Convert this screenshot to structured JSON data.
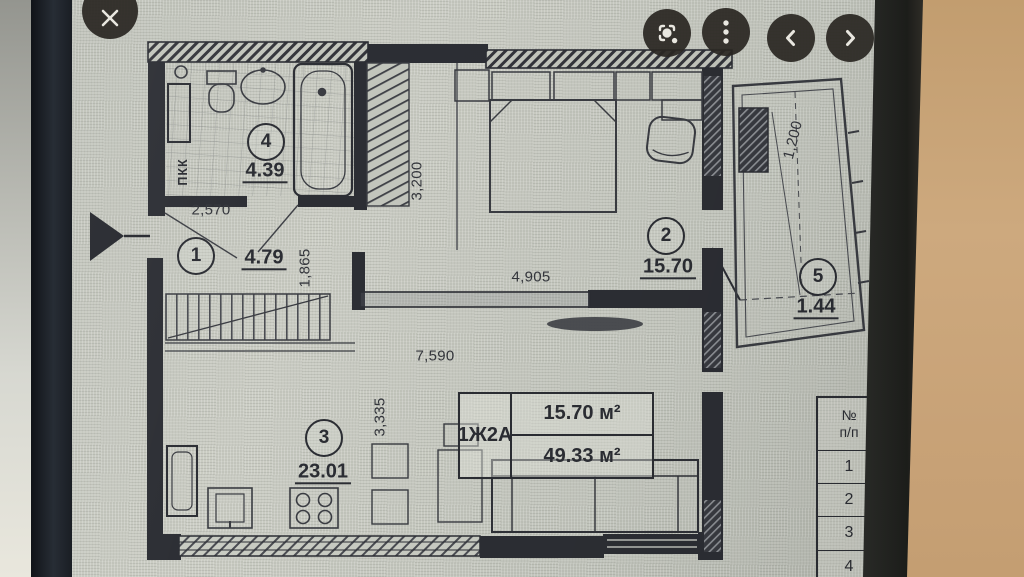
{
  "toolbar": {
    "icons": {
      "close": "close-icon",
      "lens": "lens-search-icon",
      "more": "more-options-icon",
      "previous": "previous-image-icon",
      "next": "next-image-icon"
    }
  },
  "plan": {
    "rooms": [
      {
        "number": "1",
        "area": "4.79"
      },
      {
        "number": "2",
        "area": "15.70"
      },
      {
        "number": "3",
        "area": "23.01"
      },
      {
        "number": "4",
        "area": "4.39"
      },
      {
        "number": "5",
        "area": "1.44"
      }
    ],
    "dimensions": {
      "entry_width": "2,570",
      "entry_depth": "1,865",
      "closet_wall": "3,200",
      "bedroom_width": "4,905",
      "living_width": "7,590",
      "living_depth": "3,335",
      "balcony_depth": "1,200"
    },
    "shaft_label": "ПКК",
    "apartment_tag": {
      "code": "1Ж2А",
      "living_area": "15.70 м²",
      "total_area": "49.33 м²"
    }
  },
  "side_table": {
    "header_line1": "№",
    "header_line2": "п/п",
    "rows": [
      "1",
      "2",
      "3",
      "4"
    ]
  },
  "colors": {
    "background_tan": "#c9a478",
    "bezel": "#24262b",
    "screen": "#c7cac1",
    "ink": "#2b2d33"
  }
}
